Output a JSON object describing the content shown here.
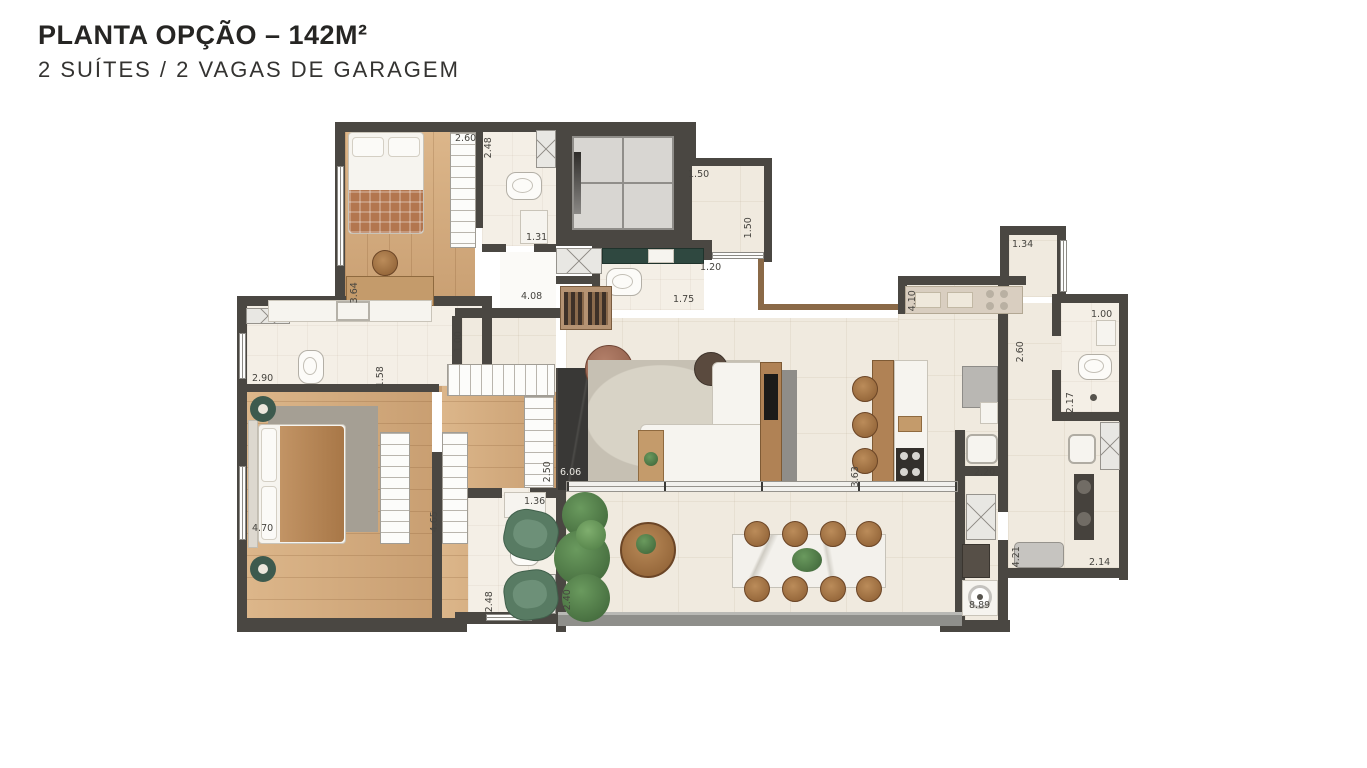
{
  "header": {
    "title": "PLANTA OPÇÃO – 142M²",
    "subtitle": "2 SUÍTES / 2 VAGAS DE GARAGEM"
  },
  "palette": {
    "wall": "#4a4742",
    "wood_floor": "#d2aa7d",
    "tile_floor": "#f0eadf",
    "green_marble": "#2f4840",
    "dark_feature_wall": "#393836",
    "terrace_chair_green": "#587b63",
    "chair_wood": "#a87a50",
    "balcony_rail": "#8f8f8b",
    "window_sill": "#8a6947"
  },
  "dims": {
    "closet2": "2.60",
    "bath2_w": "2.48",
    "bath2_l": "1.31",
    "desk": "3.64",
    "hall_w": "1.50",
    "hall_d": "1.50",
    "entry": "1.20",
    "lavabo": "1.75",
    "pass": "4.08",
    "foyer": "1.00",
    "mbath_w": "2.90",
    "mbath_d": "1.58",
    "kcounter": "4.10",
    "svc_hall": "1.34",
    "svc_corr": "2.60",
    "bath3_w": "1.00",
    "bath3_d": "2.17",
    "tanque": "2.20",
    "closet_d": "2.50",
    "master_w": "4.70",
    "closet_corr": "4.65",
    "bath4_sink": "1.36",
    "bath4_d": "2.48",
    "terrace": "2.40",
    "living": "6.06",
    "island": "3.63",
    "svc_len": "8.89",
    "svc_r": "4.21",
    "svc_w": "2.14"
  }
}
